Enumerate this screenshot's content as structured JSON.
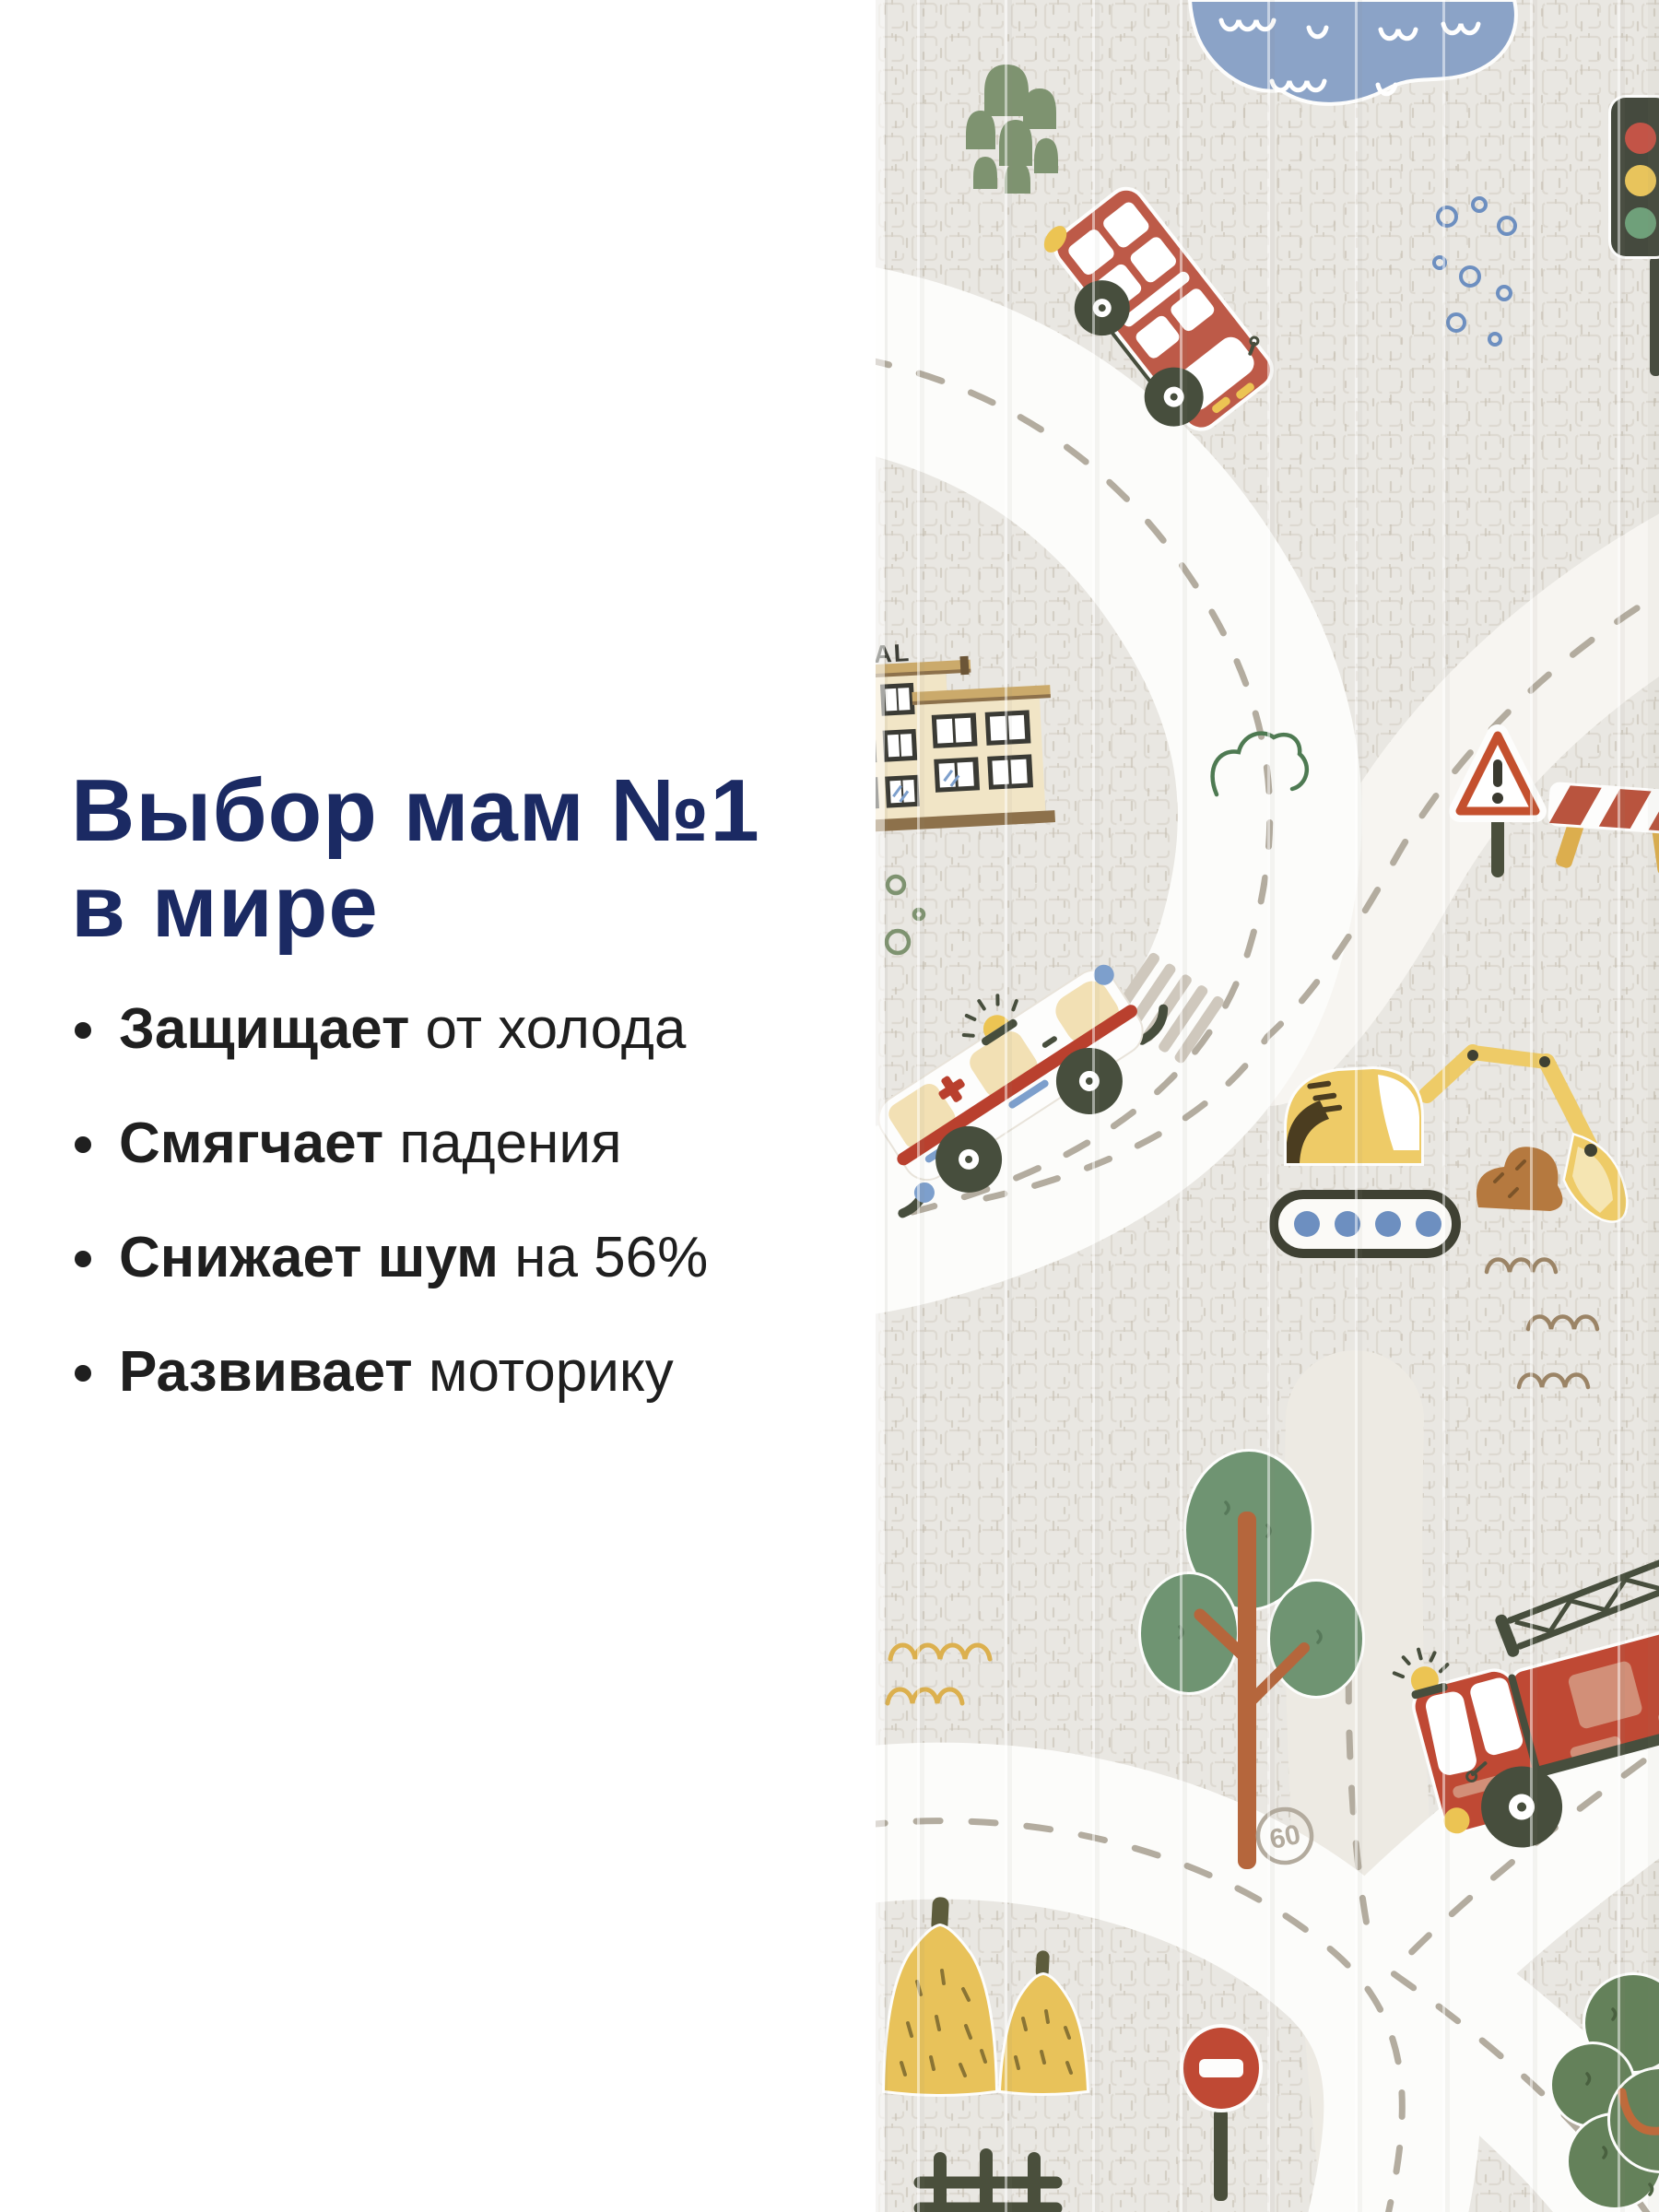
{
  "headline": {
    "line1": "Выбор мам №1",
    "line2": "в мире",
    "color": "#1b2a63"
  },
  "bullets": [
    {
      "bold": "Защищает",
      "rest": " от холода"
    },
    {
      "bold": "Смягчает",
      "rest": " падения"
    },
    {
      "bold": "Снижает шум",
      "rest": " на 56%"
    },
    {
      "bold": "Развивает",
      "rest": " моторику"
    }
  ],
  "mat": {
    "speed_limit_label": "60",
    "building_sign_text": "AL",
    "colors": {
      "mat_background": "#e9e7e2",
      "grid_line": "#d5d0c6",
      "road_white": "#fcfcfa",
      "road_dash": "#b3ac9f",
      "pond_blue": "#8ba3c7",
      "bush_green": "#7e9370",
      "bus_red": "#bd5a48",
      "chassis_dark": "#474e3d",
      "accent_yellow": "#ecc453",
      "building_cream": "#f1e5c6",
      "roof_tan": "#cbaa6b",
      "trim_brown": "#8d714b",
      "sign_red": "#c4502e",
      "stripe_red": "#b9402e",
      "window_blue": "#7d9fcc",
      "excavator_yellow": "#eecb67",
      "dirt_brown": "#b5793f",
      "tree_green": "#6f9472",
      "trunk_orange": "#b5663c",
      "wave_brown": "#9b8466",
      "hay_yellow": "#e8c25a",
      "stop_red": "#bf4934",
      "fence_dark": "#4a4f3c"
    },
    "elements": [
      "pond",
      "bushes",
      "double-decker-bus",
      "traffic-light",
      "bubbles",
      "hospital-building",
      "cloud",
      "warning-sign",
      "road-barrier",
      "ambulance",
      "crosswalk",
      "excavator",
      "tree",
      "waves",
      "scallops",
      "speed-limit-60",
      "fire-truck",
      "ladder",
      "haystacks",
      "stop-sign",
      "fence",
      "bush-tree",
      "roads",
      "fold-creases"
    ]
  }
}
